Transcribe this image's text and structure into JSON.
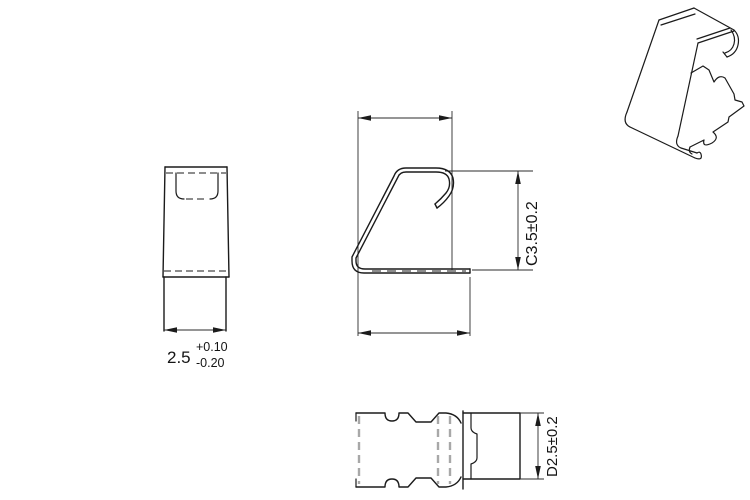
{
  "drawing": {
    "front_view": {
      "dim_value": "2.5",
      "dim_tol_plus": "+0.10",
      "dim_tol_minus": "-0.20"
    },
    "side_view": {
      "height_dim": "C3.5±0.2"
    },
    "bottom_view": {
      "height_dim": "D2.5±0.2"
    },
    "colors": {
      "line": "#1b1b1b",
      "hidden_gray": "#a8a8a8",
      "background": "#ffffff"
    }
  }
}
